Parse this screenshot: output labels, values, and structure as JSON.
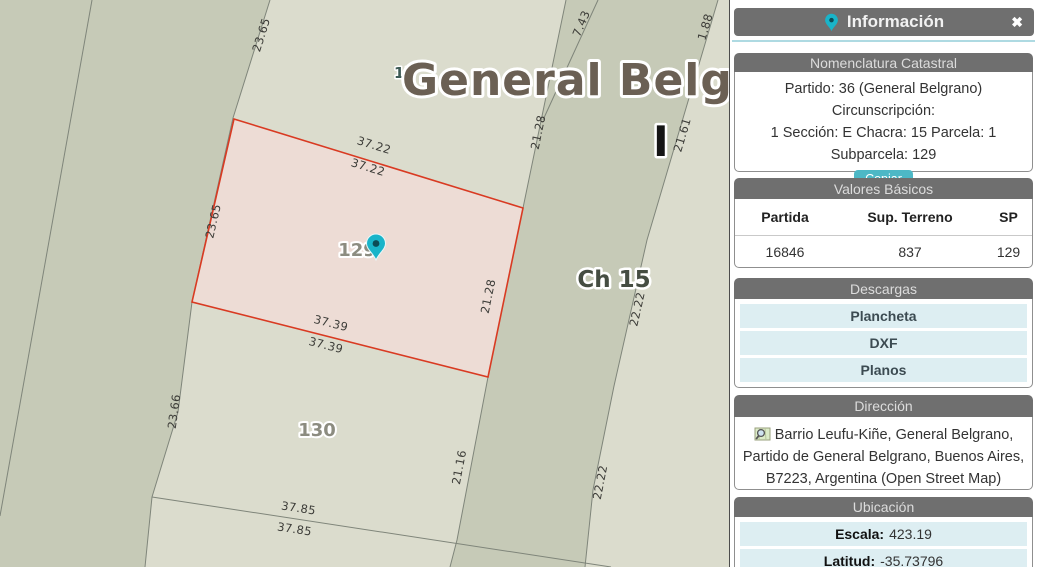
{
  "colors": {
    "accent_teal": "#4db8c6",
    "header_gray": "#6f6f6f",
    "row_cyan": "#ddeef2",
    "parcel_border_red": "#d93a22",
    "parcel_fill_pink": "#eddcd5",
    "band_green": "#c6cab7",
    "map_background": "#dbdccd",
    "pin_teal": "#19b4c9"
  },
  "map": {
    "title": "General Belgrano",
    "chacra_small": "15",
    "section_marker": "I",
    "chacra_label": "Ch 15",
    "parcel_ids": [
      "129",
      "130"
    ],
    "measurements": [
      "7.43",
      "1.88",
      "23.65",
      "21.61",
      "37.22",
      "37.22",
      "21.28",
      "23.65",
      "21.28",
      "37.39",
      "37.39",
      "23.66",
      "21.16",
      "22.22",
      "22.22",
      "37.85",
      "37.85"
    ]
  },
  "panel": {
    "title": "Información",
    "close": "✖",
    "sections": {
      "nomenclatura": {
        "title": "Nomenclatura Catastral",
        "lines": [
          "Partido: 36 (General Belgrano) Circunscripción:",
          "1 Sección: E Chacra: 15 Parcela: 1",
          "Subparcela: 129"
        ],
        "copy_label": "Copiar"
      },
      "valores": {
        "title": "Valores Básicos",
        "columns": [
          "Partida",
          "Sup. Terreno",
          "SP"
        ],
        "rows": [
          [
            "16846",
            "837",
            "129"
          ]
        ]
      },
      "descargas": {
        "title": "Descargas",
        "items": [
          "Plancheta",
          "DXF",
          "Planos"
        ]
      },
      "direccion": {
        "title": "Dirección",
        "lines": [
          "Barrio Leufu-Kiñe, General Belgrano,",
          "Partido de General Belgrano, Buenos Aires,",
          "B7223, Argentina (Open Street Map)"
        ]
      },
      "ubicacion": {
        "title": "Ubicación",
        "rows": [
          {
            "label": "Escala:",
            "value": "423.19"
          },
          {
            "label": "Latitud:",
            "value": "-35.73796"
          }
        ]
      }
    }
  }
}
